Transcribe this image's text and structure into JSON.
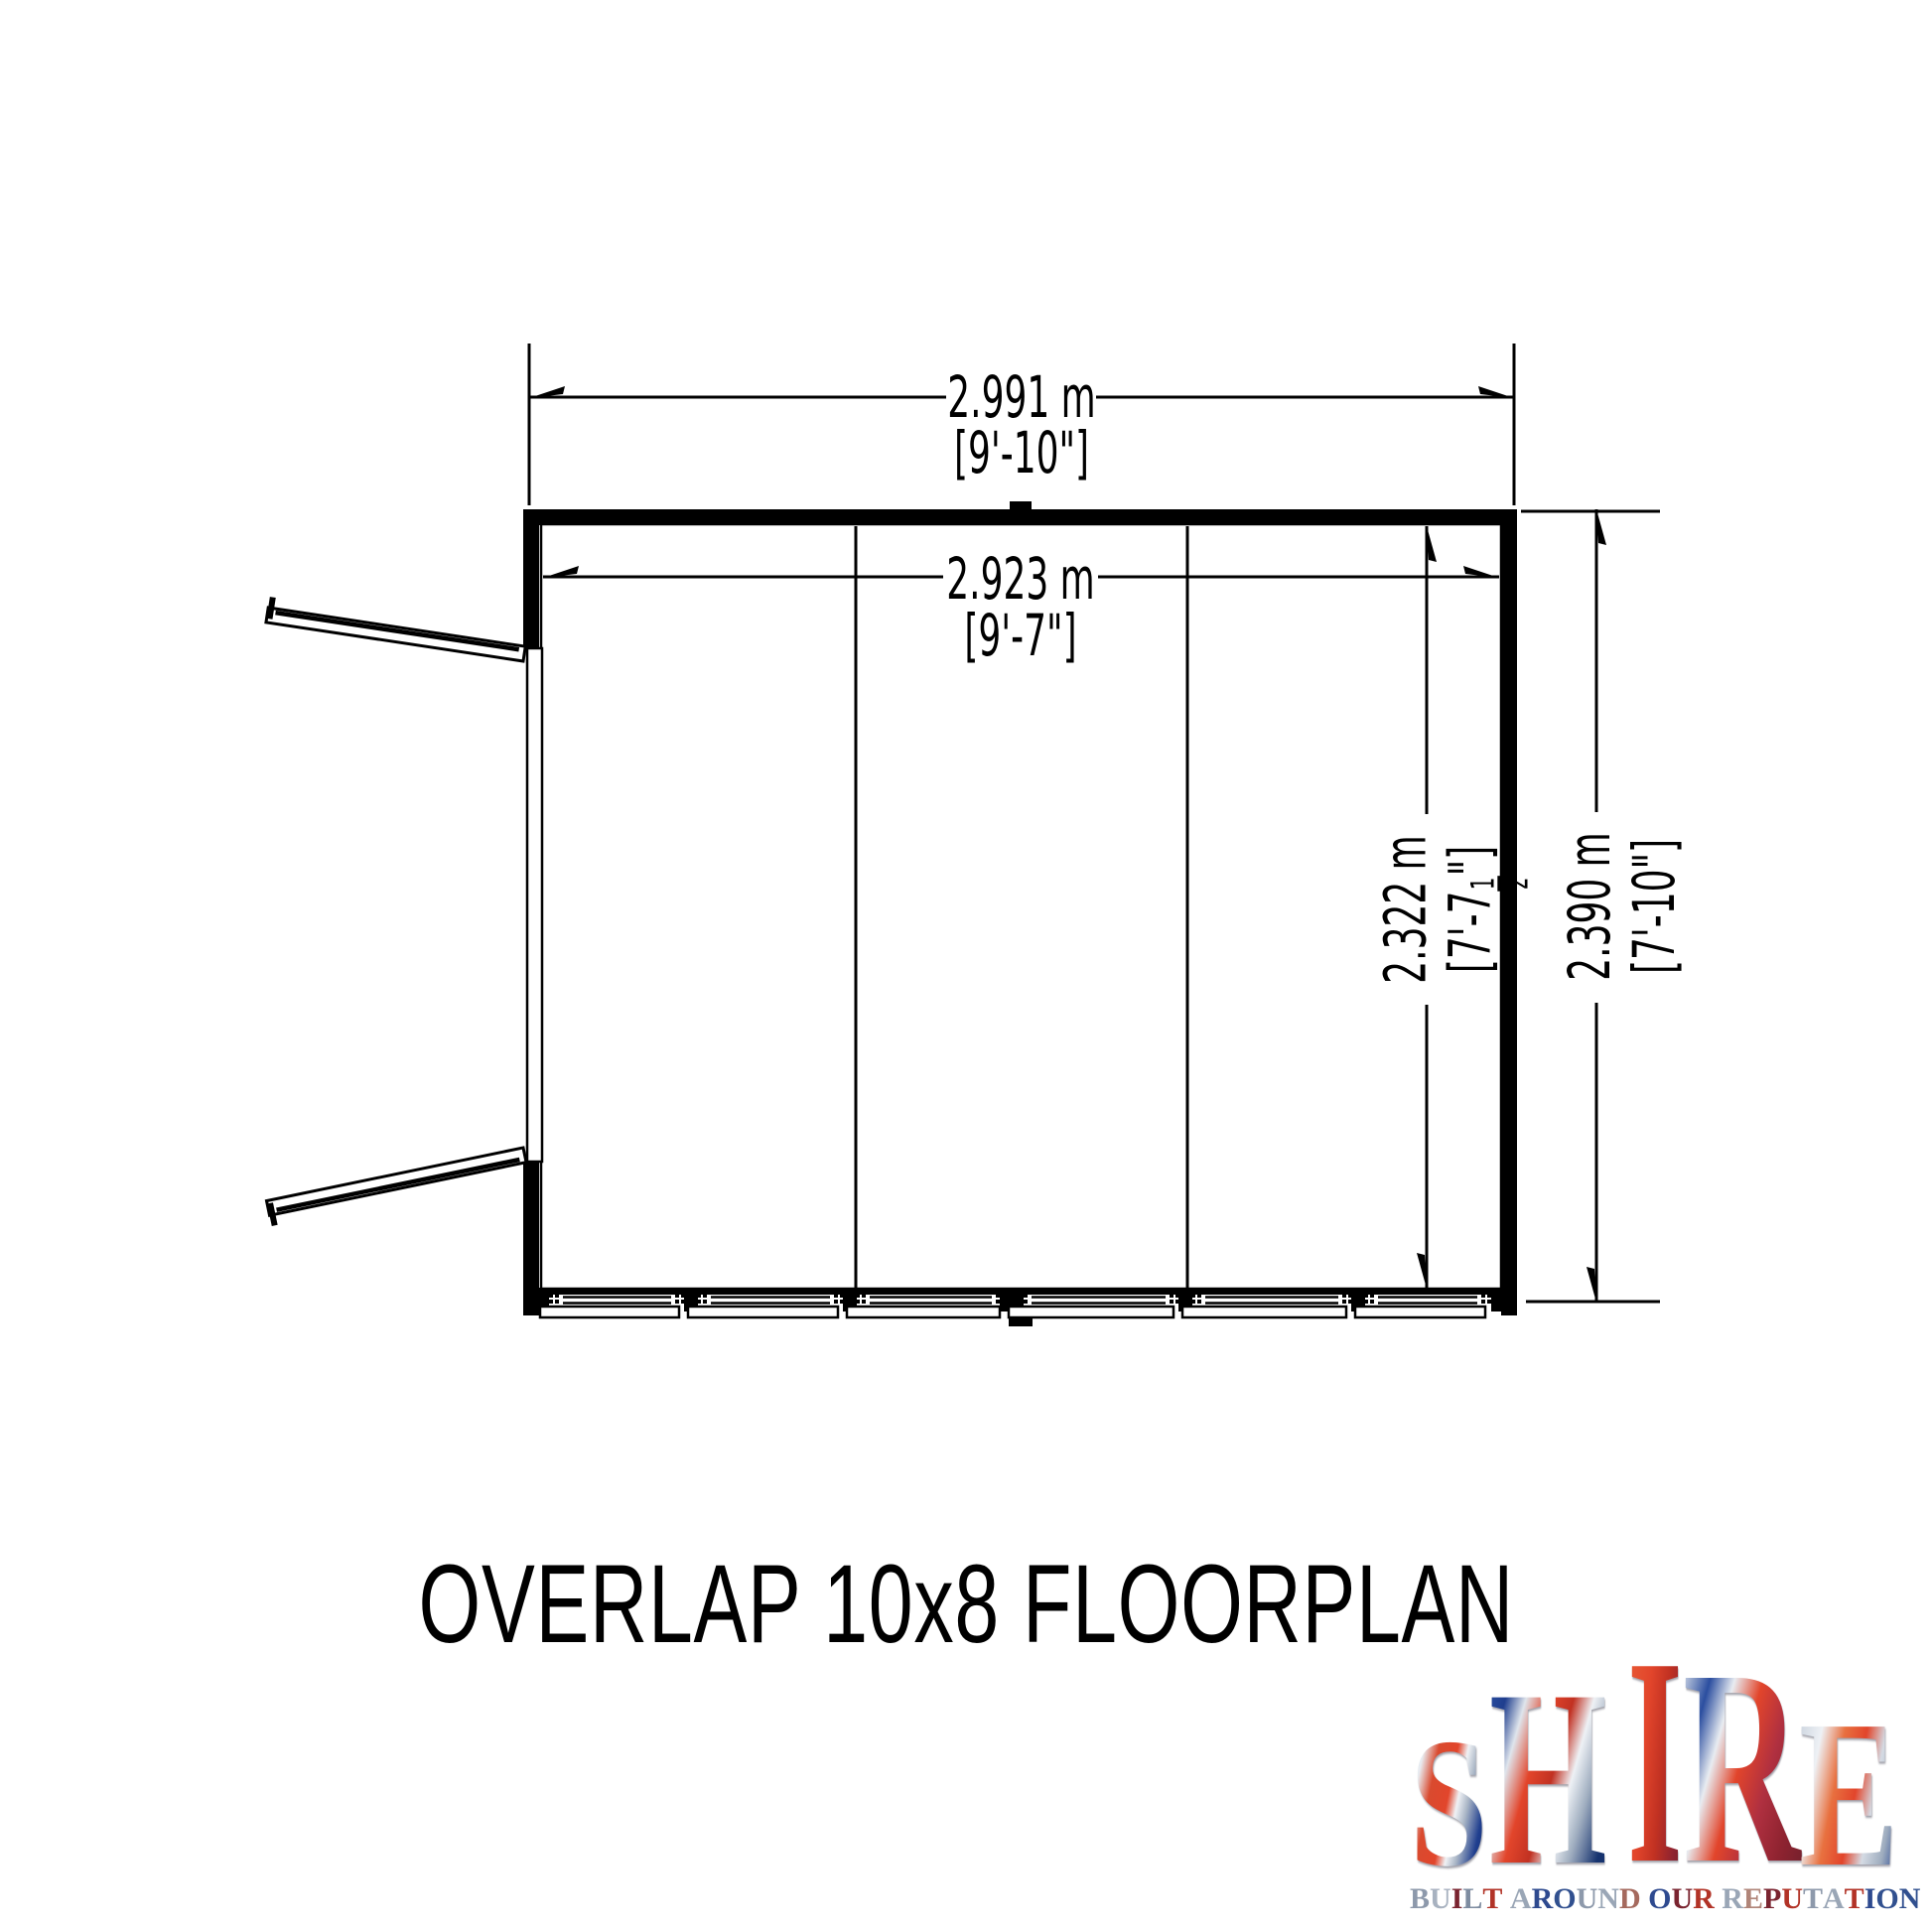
{
  "title": "OVERLAP 10x8 FLOORPLAN",
  "dimensions": {
    "width_outer": {
      "meters": "2.991 m",
      "imperial": "[9'-10\"]"
    },
    "width_inner": {
      "meters": "2.923 m",
      "imperial": "[9'-7\"]"
    },
    "depth_inner": {
      "meters": "2.322 m",
      "imperial_pre": "[7'-7",
      "frac_num": "1",
      "frac_den": "2",
      "imperial_post": "\"]"
    },
    "depth_outer": {
      "meters": "2.390 m",
      "imperial": "[7'-10\"]"
    }
  },
  "logo": {
    "letters": [
      "S",
      "H",
      "I",
      "R",
      "E"
    ],
    "tagline": "BUILT AROUND OUR REPUTATION",
    "tagline_colors": [
      "#8d99ab",
      "#a8b2c0",
      "#7a2430",
      "#7e8ca0",
      "#b23327",
      null,
      "#9aa6b6",
      "#2e4a8f",
      "#31508f",
      "#8d99ab",
      "#9aa6b6",
      "#a56a5e",
      null,
      "#2e4a8f",
      "#7a2430",
      "#b23327",
      null,
      "#9aa6b6",
      "#b08579",
      "#7a2430",
      "#b23327",
      "#8d99ab",
      "#9aa6b6",
      "#b23327",
      "#2e4a8f",
      "#31508f",
      "#31508f"
    ],
    "palette": {
      "red": "#d23f2a",
      "dark_red": "#7a2430",
      "blue": "#24418c",
      "silver": "#aab4c2"
    }
  },
  "drawing": {
    "line_color": "#000000",
    "background": "#ffffff"
  }
}
